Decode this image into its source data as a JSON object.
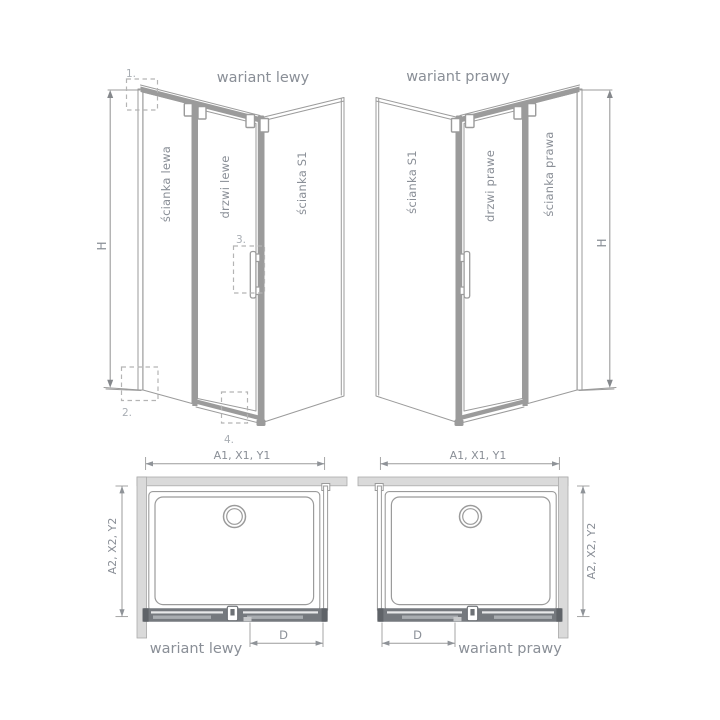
{
  "perspective_views": {
    "left": {
      "title": "wariant lewy",
      "wall_panel_label": "ścianka lewa",
      "door_label": "drzwi lewe",
      "side_panel_label": "ścianka S1",
      "height_dim_label": "H",
      "callouts": {
        "c1": "1.",
        "c2": "2.",
        "c3": "3.",
        "c4": "4."
      }
    },
    "right": {
      "title": "wariant prawy",
      "side_panel_label": "ścianka S1",
      "door_label": "drzwi prawe",
      "wall_panel_label": "ścianka prawa",
      "height_dim_label": "H"
    }
  },
  "plan_views": {
    "left": {
      "label": "wariant lewy",
      "width_dim_label": "A1, X1, Y1",
      "depth_dim_label": "A2, X2, Y2",
      "door_width_dim_label": "D"
    },
    "right": {
      "label": "wariant prawy",
      "width_dim_label": "A1, X1, Y1",
      "depth_dim_label": "A2, X2, Y2",
      "door_width_dim_label": "D"
    }
  },
  "colors": {
    "line": "#9b9b9b",
    "text": "#8a8f97",
    "callout_text": "#a9aeb4",
    "wall_fill": "#dadada",
    "rail_fill": "#75797e",
    "arrow_fill": "#85888c"
  }
}
